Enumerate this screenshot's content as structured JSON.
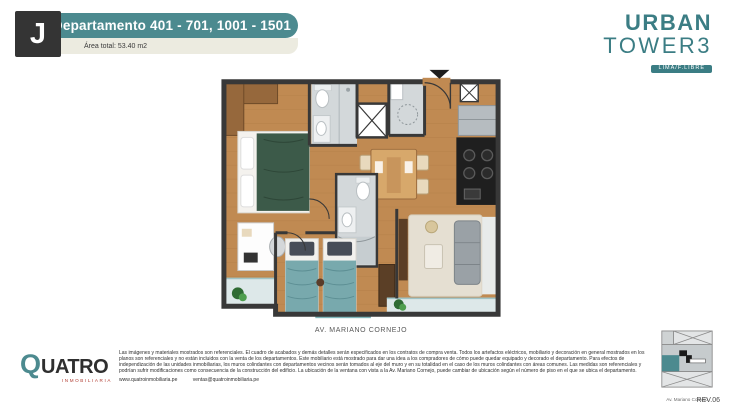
{
  "header": {
    "unit_letter": "J",
    "title": "Departamento 401 - 701, 1001 - 1501",
    "area_label": "Área total: 53.40 m2"
  },
  "brand_logo": {
    "line1": "URBAN",
    "line2": "TOWER3",
    "badge": "LIMA/F.LIBRE"
  },
  "plan": {
    "street_label": "AV. MARIANO CORNEJO"
  },
  "developer": {
    "initial": "Q",
    "name_rest": "UATRO",
    "subtitle": "INMOBILIARIA"
  },
  "legal": {
    "disclaimer": "Las imágenes y materiales mostrados son referenciales. El cuadro de acabados y demás detalles serán especificados en los contratos de compra venta. Todos los artefactos eléctricos, mobiliario y decoración en general mostrados en los planos son referenciales y no están incluidos con la venta de los departamentos. Este mobiliario está mostrado para dar una idea a los compradores de cómo puede quedar equipado y decorado el departamento. Para efectos de independización de las unidades inmobiliarias, los muros colindantes con departamentos vecinos serán tomados al eje del muro y en su totalidad en el caso de los muros colindantes con áreas comunes. Las medidas son referenciales y podrían sufrir modificaciones como consecuencia de la construcción del edificio. La ubicación de la ventana con vista a la Av. Mariano Cornejo, puede cambiar de ubicación según el número de piso en el que se ubica el departamento.",
    "website": "www.quatroinmobiliaria.pe",
    "email": "ventas@quatroinmobiliaria.pe"
  },
  "key_plan": {
    "street_label": "Av. Mariano Cornejo",
    "revision": "REV.06"
  },
  "colors": {
    "teal": "#4c8a8f",
    "dark_box": "#343434",
    "cream": "#ecebe0",
    "logo_teal": "#3b7d84",
    "brand_red": "#b03a30",
    "wood_floor": "#c08a52",
    "wall": "#383838",
    "bathroom_gray": "#d3d8da",
    "bed_green": "#3c5a49",
    "bed_teal": "#78a9ad"
  }
}
